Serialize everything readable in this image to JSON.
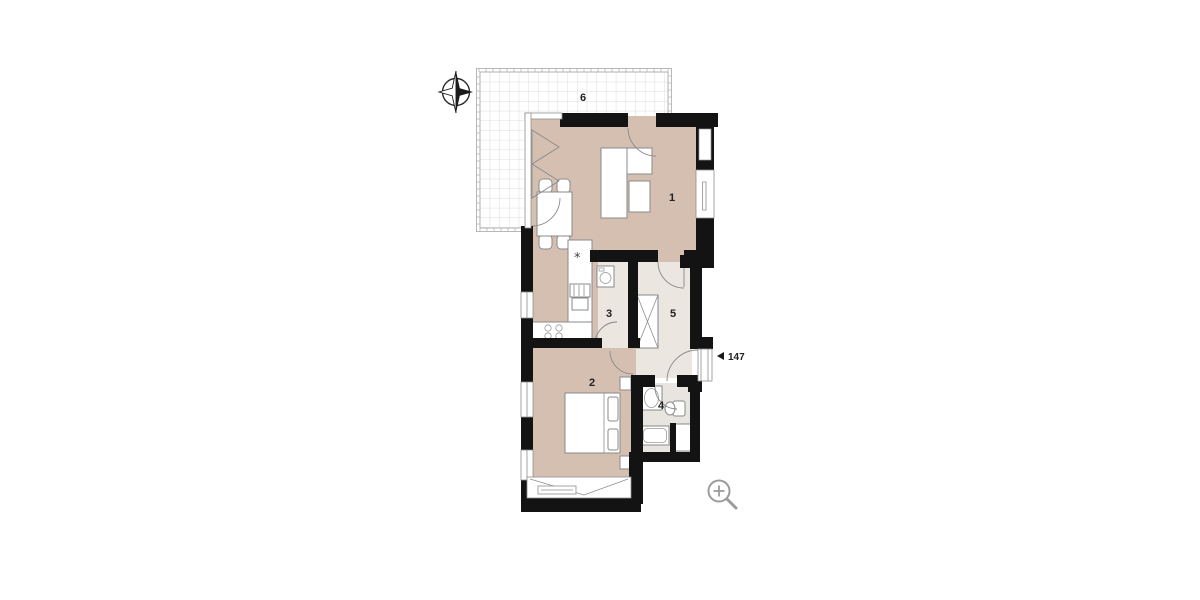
{
  "canvas": {
    "background": "#ffffff"
  },
  "colors": {
    "wall": "#131313",
    "floor_main": "#d5bfb1",
    "floor_service": "#ebe6df",
    "floor_bath": "#e8e4df",
    "terrace_grid": "#dcdcdc",
    "icon_gray": "#9b9b9b",
    "label": "#222222"
  },
  "floorplan": {
    "rooms": [
      {
        "number": "1",
        "name": "living-room"
      },
      {
        "number": "2",
        "name": "bedroom"
      },
      {
        "number": "3",
        "name": "storage"
      },
      {
        "number": "4",
        "name": "bathroom"
      },
      {
        "number": "5",
        "name": "hallway"
      },
      {
        "number": "6",
        "name": "terrace"
      }
    ],
    "entrance_label": "147",
    "kitchen_symbol": "*"
  },
  "icons": {
    "compass": "compass-rose",
    "zoom": "zoom-in"
  }
}
